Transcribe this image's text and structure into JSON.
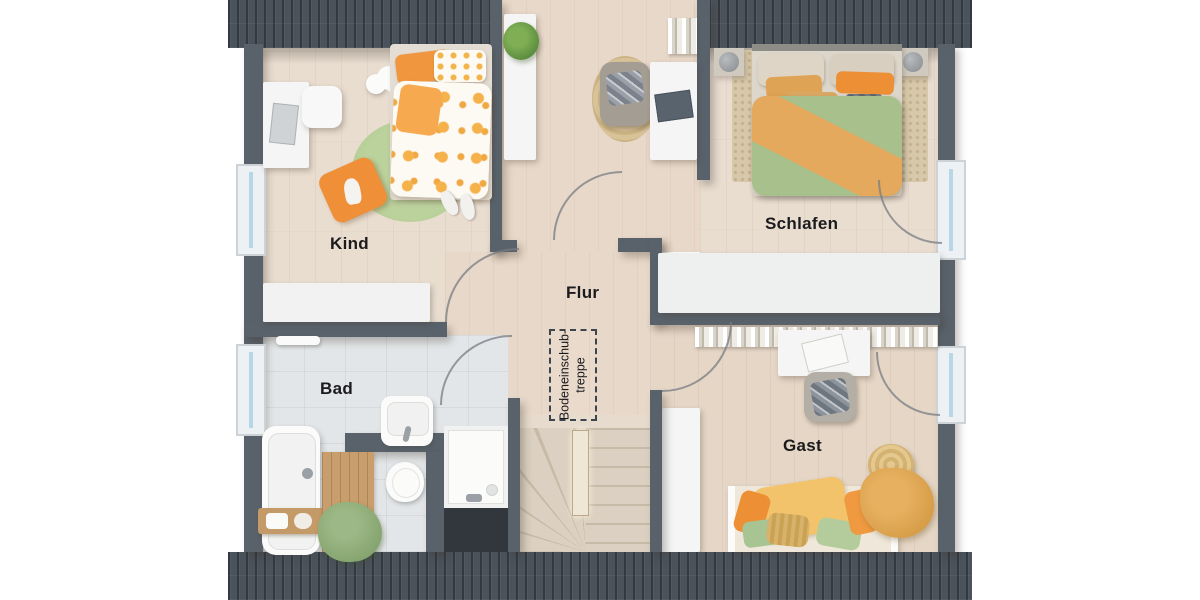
{
  "floorplan": {
    "rooms": [
      {
        "id": "kind",
        "label": "Kind"
      },
      {
        "id": "schlafen",
        "label": "Schlafen"
      },
      {
        "id": "flur",
        "label": "Flur"
      },
      {
        "id": "bad",
        "label": "Bad"
      },
      {
        "id": "gast",
        "label": "Gast"
      }
    ],
    "annotations": {
      "loft_hatch_line1": "Bodeneinschub-",
      "loft_hatch_line2": "treppe"
    },
    "openings": {
      "left_wall_windows": 2,
      "right_wall_windows": 2,
      "interior_door_arcs": 4,
      "window_door_arcs": 2
    },
    "colors": {
      "roof": "#4a525b",
      "wall": "#59626b",
      "wood_floor": "#e9ddd0",
      "hall_floor": "#e8d8c9",
      "tile_floor": "#e3e6e8",
      "stair_wood": "#d8ccbd",
      "accent_orange": "#f0963f",
      "accent_green": "#a6c28d",
      "accent_yellow": "#f2c36a",
      "label_text": "#1b1b1d",
      "background": "#ffffff"
    },
    "furniture": {
      "kind": [
        "desk",
        "desk-chair",
        "laptop",
        "cloud-shelf",
        "single-bed",
        "polka-dot-duvet",
        "round-rug",
        "floor-cushion",
        "slippers",
        "sideboard"
      ],
      "flur": [
        "tall-cabinet",
        "potted-plant",
        "round-jute-rug",
        "armchair",
        "desk",
        "laptop",
        "books",
        "loft-hatch",
        "winder-staircase",
        "stair-cabinet"
      ],
      "schlafen": [
        "double-bed",
        "nightstand-left",
        "nightstand-right",
        "table-lamps",
        "area-rug",
        "wardrobe"
      ],
      "bad": [
        "bathtub",
        "bath-caddy",
        "wooden-mat",
        "towel-pile",
        "washbasin",
        "toilet",
        "shower",
        "towel-rail"
      ],
      "gast": [
        "bookshelf",
        "desk",
        "laptop",
        "armchair",
        "guest-bed",
        "knitted-pouf",
        "throw-blanket"
      ]
    }
  }
}
